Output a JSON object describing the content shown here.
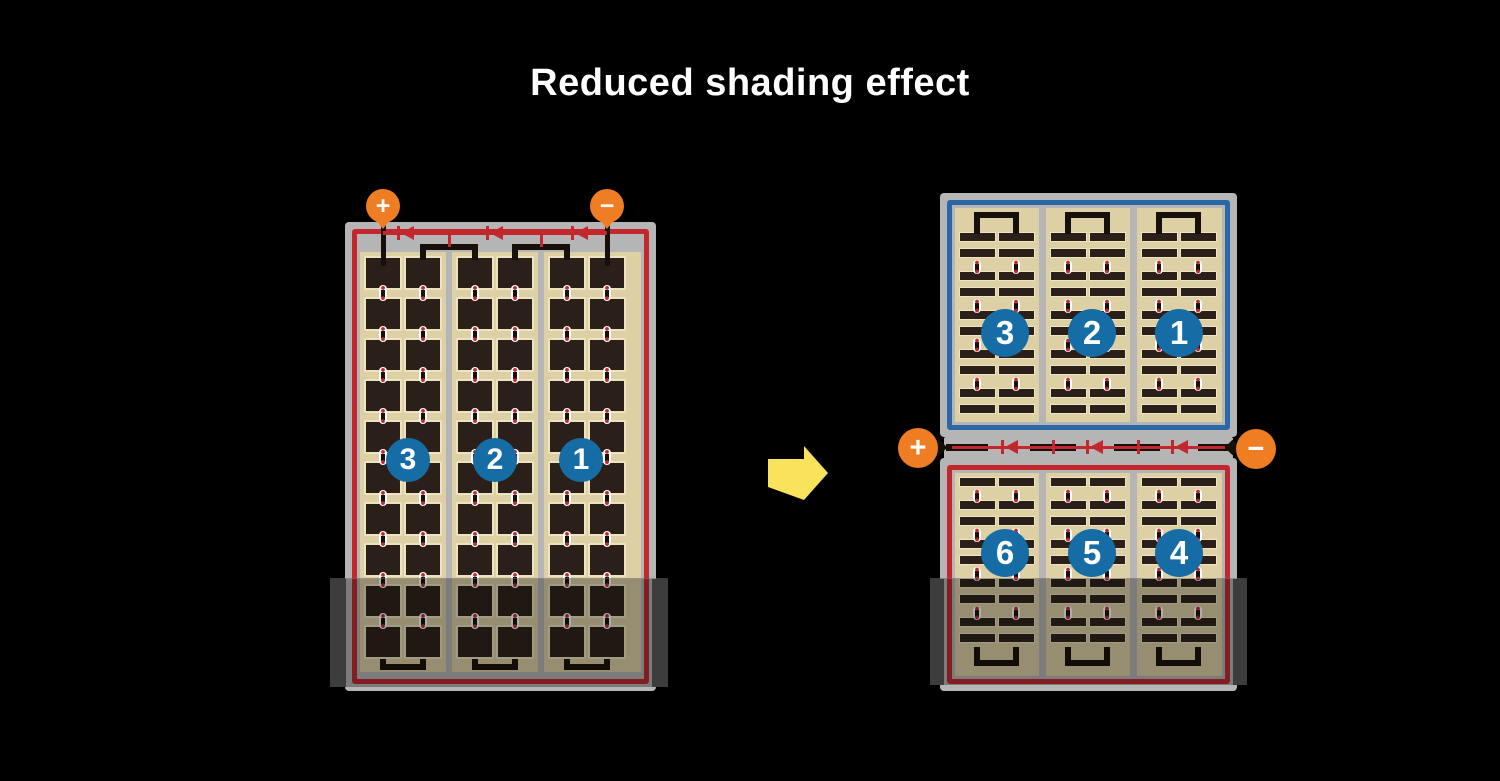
{
  "title": "Reduced shading effect",
  "colors": {
    "background": "#000000",
    "title_text": "#ffffff",
    "module_frame": "#b5b5b5",
    "cell_field": "#ddd0a4",
    "cell": "#2b2019",
    "cell_outline": "#eee3c0",
    "red_circuit": "#c1272d",
    "blue_circuit": "#2a67a5",
    "number_circle": "#166da5",
    "terminal": "#ee7d23",
    "arrow": "#f9e25c",
    "wire": "#17100a",
    "shade_tab": "#3d3d3d"
  },
  "left_module": {
    "terminals": {
      "positive": "+",
      "negative": "−"
    },
    "strings": [
      {
        "number": "3"
      },
      {
        "number": "2"
      },
      {
        "number": "1"
      }
    ],
    "grid": {
      "string_count": 3,
      "columns_per_string": 2,
      "cell_rows": 10,
      "bypass_diodes": 3
    },
    "shaded": true
  },
  "right_top_module": {
    "strings": [
      {
        "number": "3"
      },
      {
        "number": "2"
      },
      {
        "number": "1"
      }
    ],
    "grid": {
      "string_count": 3,
      "columns_per_string": 2,
      "cell_rows": 10
    },
    "shaded": false
  },
  "right_bottom_module": {
    "strings": [
      {
        "number": "6"
      },
      {
        "number": "5"
      },
      {
        "number": "4"
      }
    ],
    "grid": {
      "string_count": 3,
      "columns_per_string": 2,
      "cell_rows": 9
    },
    "shaded": true
  },
  "junction": {
    "terminals": {
      "positive": "+",
      "negative": "−"
    },
    "bypass_diodes": 3
  }
}
